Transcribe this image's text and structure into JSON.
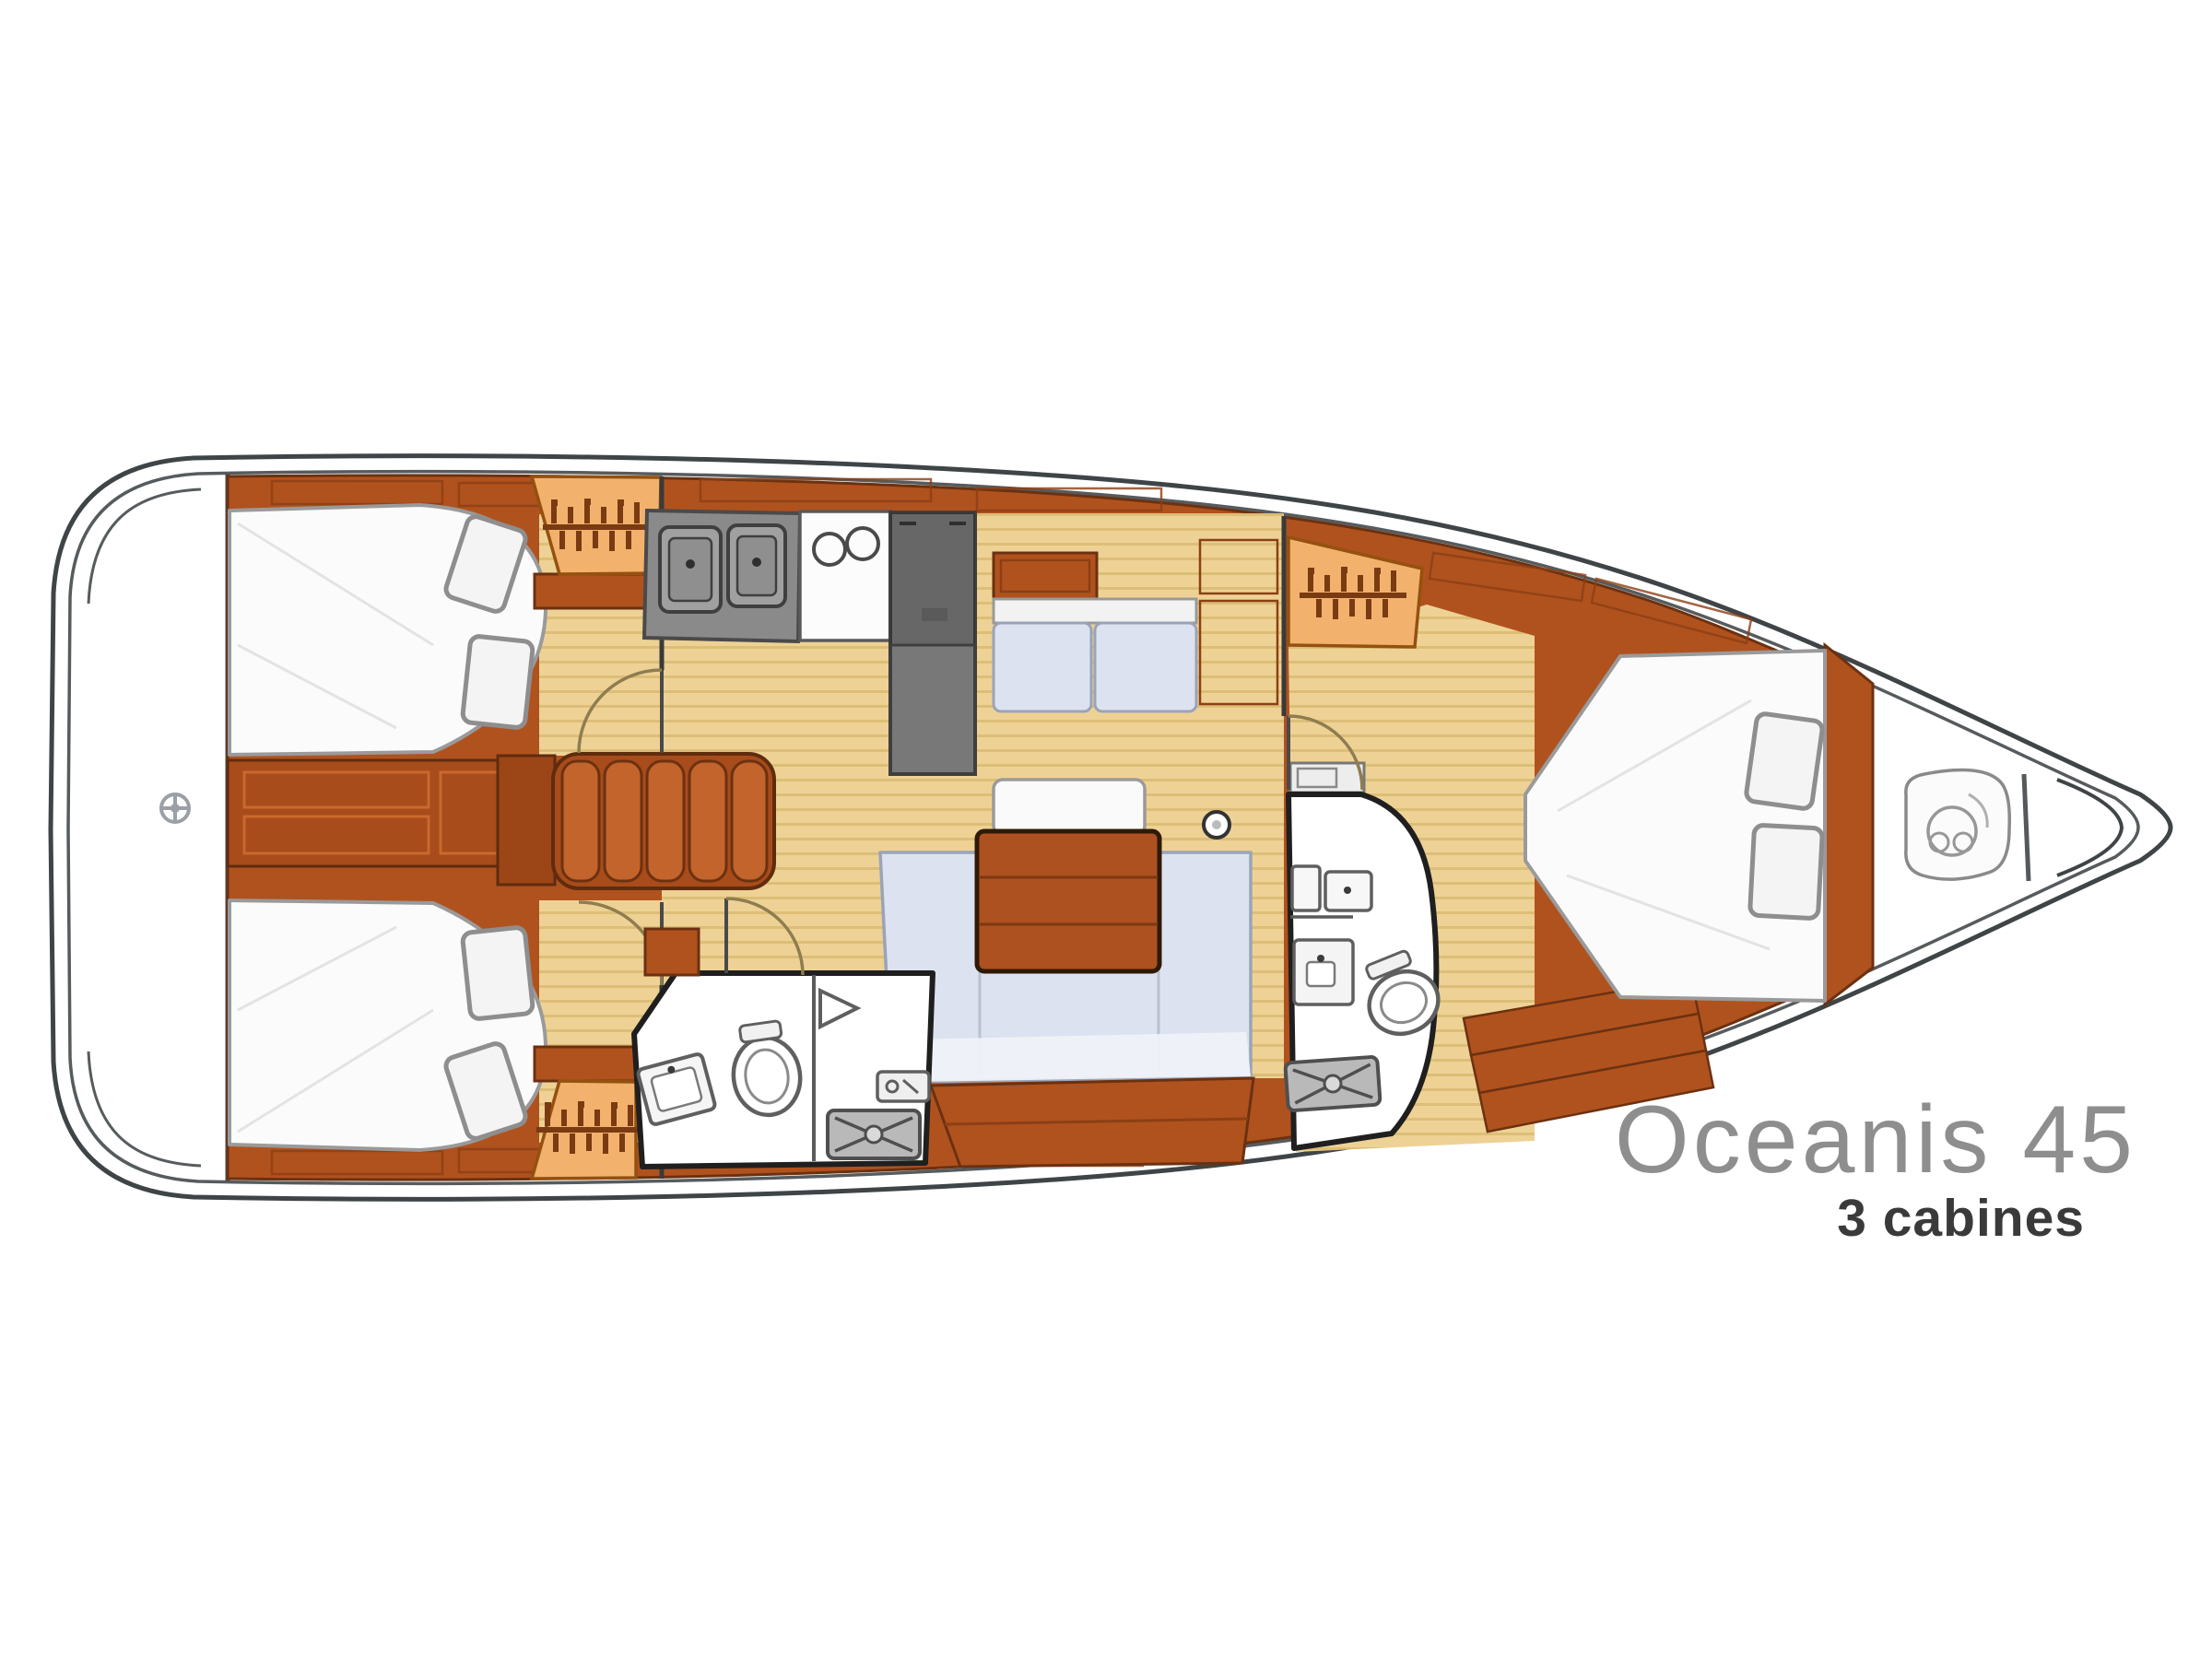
{
  "plan": {
    "title": "Oceanis 45",
    "subtitle": "3 cabines",
    "type": "sailing-yacht interior layout, plan view, bow pointing right",
    "colors": {
      "hull_outline": "#3f4447",
      "joinery_wood": "#b0521e",
      "joinery_wood_border": "#6b3110",
      "locker_peach": "#f2b26d",
      "locker_symbol_brown": "#7a3b12",
      "cabin_sole_tan": "#eed295",
      "sole_stripe": "#dcbe77",
      "upholstery_blue": "#dce2ef",
      "mattress_white": "#fbfbfb",
      "appliance_gray": "#787878",
      "counter_gray": "#8a8a8a",
      "head_wall_black": "#1f1f1f",
      "shower_grate_gray": "#b9b9b9",
      "door_arc_tan": "#8f7d50",
      "title_gray": "#8e8e8e",
      "subtitle_dark": "#3a3a3a"
    },
    "icons": [
      "helm-wheel-icon",
      "hanger-rail-icon",
      "sink-icon",
      "burner-icon",
      "fridge-icon",
      "toilet-icon",
      "shower-grate-icon",
      "shower-mixer-icon",
      "mast-post-icon",
      "windlass-icon"
    ]
  }
}
